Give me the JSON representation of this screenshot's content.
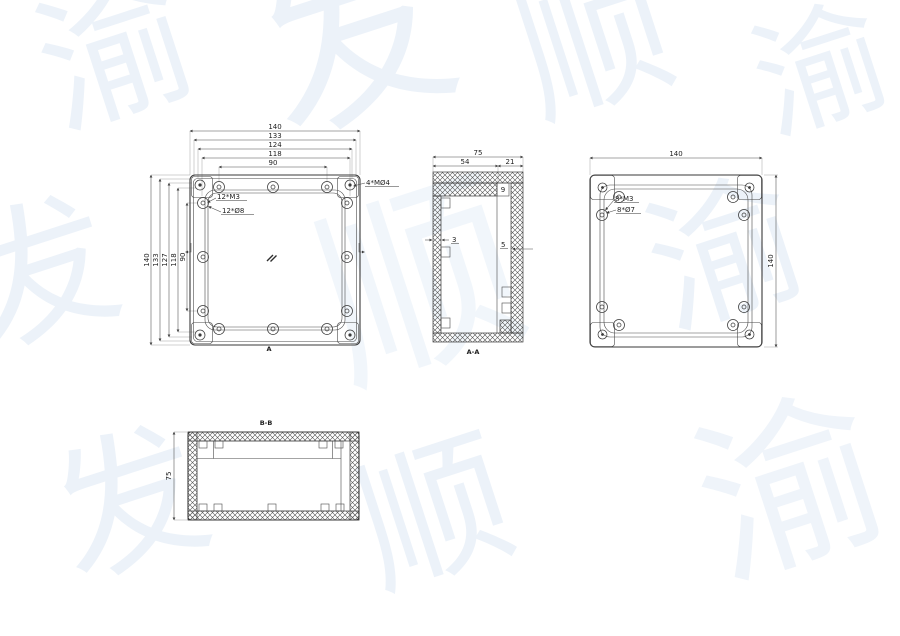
{
  "watermark": {
    "color": "#7aa2d4",
    "glyphs": [
      "渝",
      "发",
      "顺",
      "渝",
      "发",
      "顺",
      "渝",
      "发",
      "顺",
      "渝"
    ]
  },
  "front_view": {
    "top_dims": [
      "140",
      "133",
      "124",
      "118",
      "90"
    ],
    "left_dims": [
      "140",
      "133",
      "127",
      "118",
      "90"
    ],
    "callouts": {
      "thread": "12*M3",
      "hole": "12*Ø8",
      "mount": "4*MØ4"
    },
    "section_marker": "A"
  },
  "section_a": {
    "label": "A-A",
    "dims": {
      "total": "75",
      "left": "54",
      "right": "21",
      "step": "9",
      "wall_left": "3",
      "wall_right": "5"
    }
  },
  "back_view": {
    "dims": {
      "width": "140",
      "height": "140"
    },
    "callouts": {
      "thread": "8*M3",
      "hole": "8*Ø7"
    }
  },
  "section_b": {
    "label": "B-B",
    "dims": {
      "height": "75"
    }
  }
}
